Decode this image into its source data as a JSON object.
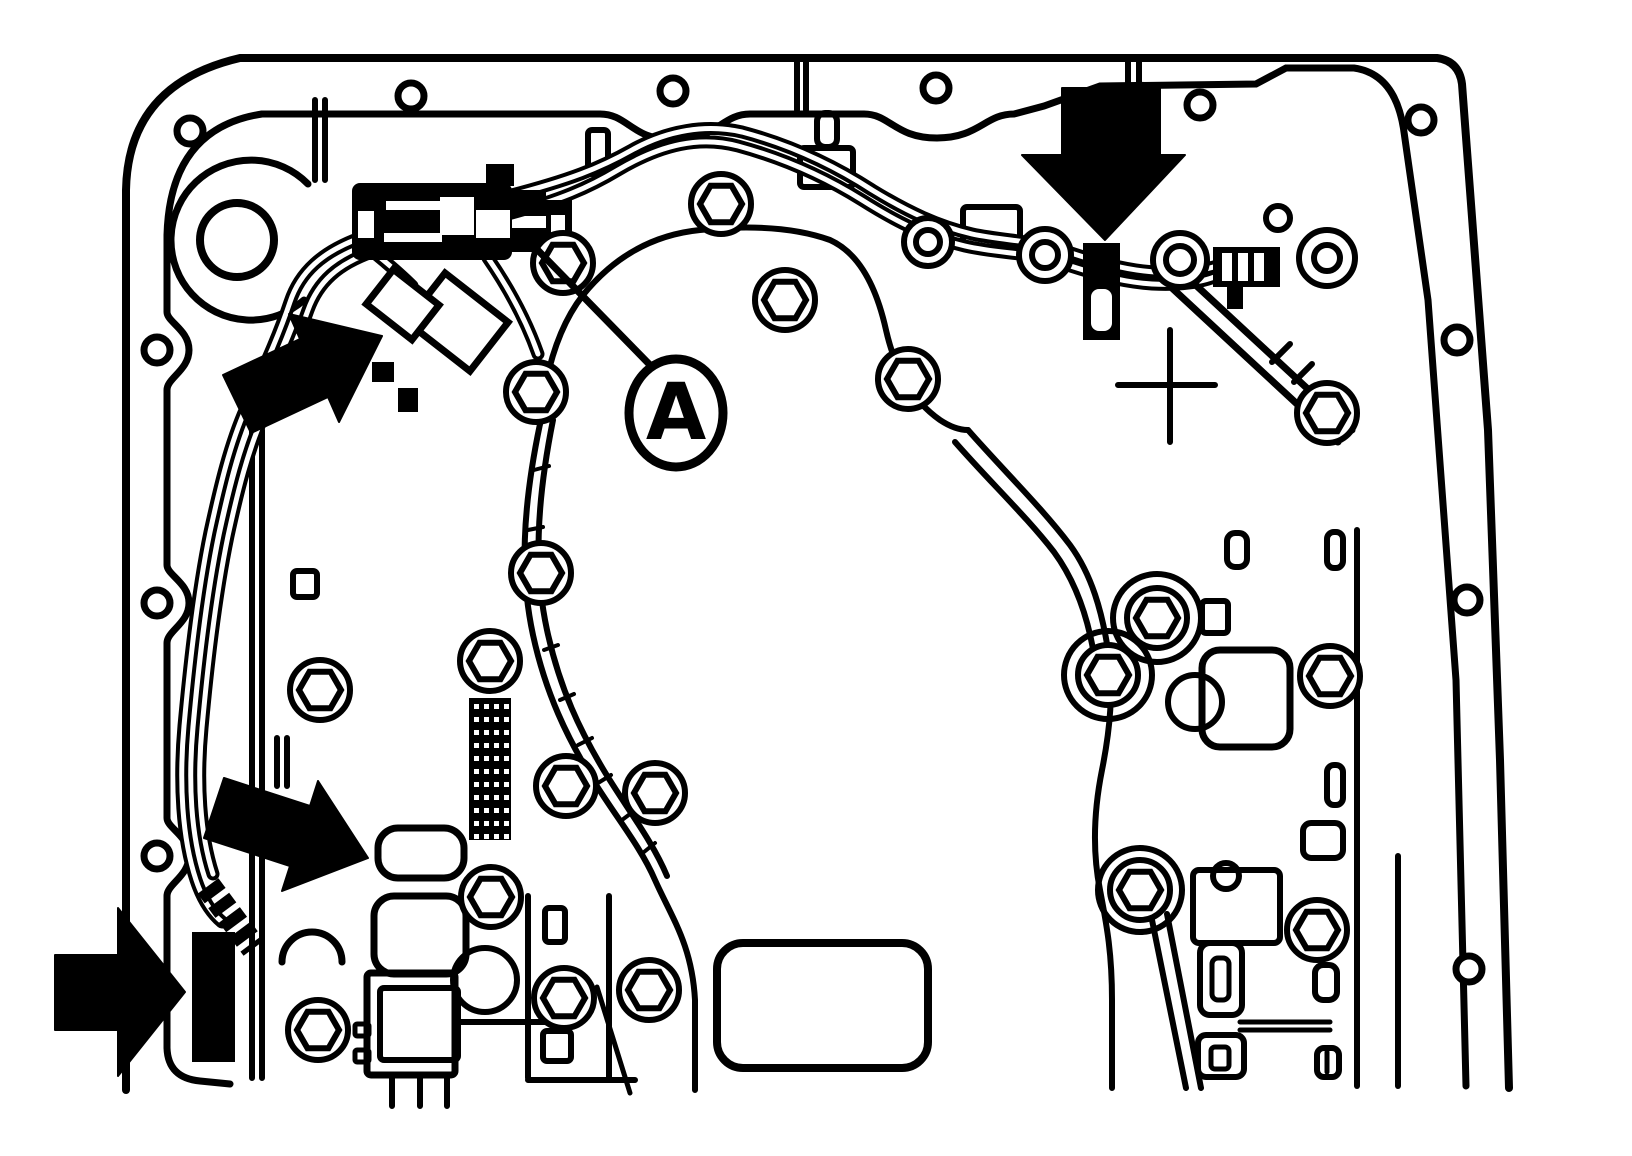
{
  "figure": {
    "kind": "technical-line-drawing",
    "subject": "automatic-transmission-valve-body-with-wiring-harness",
    "background_color": "#ffffff",
    "line_color": "#000000",
    "width": 1632,
    "height": 1156
  },
  "callouts": {
    "a": {
      "text": "A",
      "cx": 676,
      "cy": 413,
      "rx": 47,
      "ry": 54,
      "font_size": 78,
      "leader": "M 651 366 L 522 234"
    }
  },
  "arrows": [
    {
      "name": "arrow-top-right-connector",
      "points": "1062,88 1160,88 1160,155 1185,155 1105,240 1022,155 1062,155",
      "direction": "down"
    },
    {
      "name": "arrow-left-harness-plug",
      "points": "382,336 339,422 328,397 251,433 223,375 300,339 289,314",
      "direction": "up-right"
    },
    {
      "name": "arrow-mid-solenoid",
      "points": "368,858 282,891 290,866 204,838 224,778 310,806 318,781",
      "direction": "down-right"
    },
    {
      "name": "arrow-far-left-solenoid",
      "points": "55,955 118,955 118,908 185,992 118,1076 118,1030 55,1030",
      "direction": "right"
    }
  ],
  "diagram": {
    "case_paths": [
      {
        "d": "M 126 1090 L 126 190 Q 128 84 240 58 L 1437 58 Q 1459 61 1462 84 L 1488 430 L 1500 760 L 1509 1088",
        "w": 8
      },
      {
        "d": "M 262 114 L 600 114 C 628 114 632 140 674 140 C 716 140 722 114 750 114 L 864 114 C 890 114 895 138 937 138 C 979 138 985 114 1014 114 L 1044 106 L 1100 86 L 1256 84 L 1286 68 L 1354 68 Q 1396 74 1404 132 L 1428 300 L 1456 680 L 1466 1086",
        "w": 7
      },
      {
        "d": "M 262 114 Q 170 128 167 235 L 167 312 C 167 322 189 330 189 350 C 189 370 167 378 167 390 L 167 565 C 167 575 189 583 189 603 C 189 623 167 631 167 643 L 167 818 C 167 828 189 836 189 856 C 189 876 167 884 167 896 L 167 1048 Q 168 1078 200 1081 L 230 1084",
        "w": 7
      },
      {
        "d": "M 1357 530 L 1357 1086",
        "w": 6
      },
      {
        "d": "M 1398 856 L 1398 1086",
        "w": 6
      },
      {
        "d": "M 308 184 A 80 80 0 1 0 304 300",
        "w": 7
      },
      {
        "d": "M 540 424 Q 548 340 583 295 Q 630 237 700 230 Q 780 222 830 240 Q 870 258 886 330 Q 900 392 940 420 Q 955 430 968 430",
        "w": 6
      },
      {
        "d": "M 540 424 C 522 510 520 575 533 635 C 546 695 568 738 590 775 C 612 812 640 845 655 880 C 672 918 692 945 695 1000 L 695 1090",
        "w": 6
      },
      {
        "d": "M 553 420 C 536 505 534 570 547 630 C 560 690 581 732 603 769 C 625 806 652 840 667 876",
        "w": 6
      },
      {
        "d": "M 968 430 C 1005 472 1042 508 1070 545 C 1092 575 1102 612 1108 650 C 1114 690 1110 730 1102 770 C 1094 810 1092 850 1100 890 C 1106 922 1112 950 1112 1000 L 1112 1088",
        "w": 6
      },
      {
        "d": "M 955 442 C 990 482 1026 516 1054 552 C 1076 582 1088 618 1094 655",
        "w": 6
      },
      {
        "d": "M 1152 920 L 1186 1088",
        "w": 6
      },
      {
        "d": "M 1167 914 L 1201 1088",
        "w": 6
      },
      {
        "d": "M 252 392 L 252 1078 M 262 430 L 262 1078",
        "w": 6
      },
      {
        "d": "M 277 738 L 277 786 M 287 738 L 287 786",
        "w": 6
      },
      {
        "d": "M 315 100 L 315 180 M 325 100 L 325 180",
        "w": 6
      },
      {
        "d": "M 797 60 L 797 110 M 806 60 L 806 110",
        "w": 6
      },
      {
        "d": "M 1128 62 L 1128 112 M 1139 62 L 1139 112",
        "w": 6
      },
      {
        "d": "M 528 896 L 528 1078 M 609 896 L 609 1078 M 528 1080 L 635 1080",
        "w": 6
      },
      {
        "d": "M 458 1022 L 562 1022",
        "w": 6
      },
      {
        "d": "M 392 1075 L 392 1106 M 420 1075 L 420 1106 M 447 1075 L 447 1106",
        "w": 6
      },
      {
        "d": "M 282 962 A 30 30 0 1 1 342 962",
        "w": 7
      },
      {
        "d": "M 597 987 L 630 1093",
        "w": 5
      },
      {
        "d": "M 1118 385 L 1215 385 M 1170 330 L 1170 442",
        "w": 6
      },
      {
        "d": "M 534 470 L 549 466 M 528 530 L 543 527 M 530 590 L 545 588 M 544 650 L 558 645 M 560 700 L 574 694 M 578 745 L 592 738 M 598 783 L 611 775 M 622 820 L 634 811 M 644 852 L 655 843",
        "w": 4
      },
      {
        "d": "M 1240 1022 L 1330 1022 M 1240 1030 L 1330 1030",
        "w": 5
      },
      {
        "d": "M 1327 1052 L 1327 1072",
        "w": 5
      }
    ],
    "kickdown_paths": [
      {
        "d": "M 1172 288 L 1338 442",
        "w": 7
      },
      {
        "d": "M 1186 276 L 1352 430",
        "w": 7
      },
      {
        "d": "M 1272 362 L 1290 344 M 1294 382 L 1312 364",
        "w": 6
      }
    ],
    "stroke_rects": [
      {
        "x": 293,
        "y": 571,
        "w": 24,
        "h": 26,
        "rx": 4,
        "sw": 6
      },
      {
        "x": 545,
        "y": 908,
        "w": 20,
        "h": 34,
        "rx": 4,
        "sw": 6
      },
      {
        "x": 543,
        "y": 1031,
        "w": 28,
        "h": 30,
        "rx": 4,
        "sw": 6
      },
      {
        "x": 1327,
        "y": 532,
        "w": 16,
        "h": 36,
        "rx": 7,
        "sw": 6
      },
      {
        "x": 1227,
        "y": 533,
        "w": 20,
        "h": 34,
        "rx": 8,
        "sw": 6
      },
      {
        "x": 1327,
        "y": 765,
        "w": 16,
        "h": 40,
        "rx": 7,
        "sw": 6
      },
      {
        "x": 1303,
        "y": 823,
        "w": 40,
        "h": 35,
        "rx": 8,
        "sw": 6
      },
      {
        "x": 1200,
        "y": 943,
        "w": 42,
        "h": 72,
        "rx": 10,
        "sw": 6
      },
      {
        "x": 1212,
        "y": 958,
        "w": 17,
        "h": 42,
        "rx": 6,
        "sw": 5
      },
      {
        "x": 1198,
        "y": 1035,
        "w": 46,
        "h": 42,
        "rx": 8,
        "sw": 6
      },
      {
        "x": 1211,
        "y": 1047,
        "w": 18,
        "h": 22,
        "rx": 4,
        "sw": 5
      },
      {
        "x": 1315,
        "y": 965,
        "w": 22,
        "h": 35,
        "rx": 8,
        "sw": 6
      },
      {
        "x": 1317,
        "y": 1048,
        "w": 22,
        "h": 29,
        "rx": 7,
        "sw": 6
      },
      {
        "x": 1202,
        "y": 650,
        "w": 88,
        "h": 97,
        "rx": 18,
        "sw": 7
      },
      {
        "x": 1202,
        "y": 601,
        "w": 26,
        "h": 32,
        "rx": 4,
        "sw": 6
      },
      {
        "x": 1193,
        "y": 870,
        "w": 87,
        "h": 73,
        "rx": 6,
        "sw": 6
      },
      {
        "x": 963,
        "y": 207,
        "w": 57,
        "h": 40,
        "rx": 4,
        "sw": 6
      },
      {
        "x": 800,
        "y": 148,
        "w": 53,
        "h": 39,
        "rx": 4,
        "sw": 6
      },
      {
        "x": 588,
        "y": 130,
        "w": 20,
        "h": 44,
        "rx": 4,
        "sw": 6
      },
      {
        "x": 817,
        "y": 113,
        "w": 20,
        "h": 34,
        "rx": 8,
        "sw": 6
      },
      {
        "x": 717,
        "y": 943,
        "w": 211,
        "h": 125,
        "rx": 26,
        "sw": 8
      },
      {
        "x": 367,
        "y": 973,
        "w": 88,
        "h": 102,
        "rx": 4,
        "sw": 7
      },
      {
        "x": 355,
        "y": 1024,
        "w": 14,
        "h": 12,
        "rx": 2,
        "sw": 5
      },
      {
        "x": 355,
        "y": 1050,
        "w": 14,
        "h": 12,
        "rx": 2,
        "sw": 5
      },
      {
        "x": 378,
        "y": 828,
        "w": 86,
        "h": 50,
        "rx": 20,
        "sw": 7
      },
      {
        "x": 374,
        "y": 896,
        "w": 92,
        "h": 78,
        "rx": 20,
        "sw": 7
      },
      {
        "x": 380,
        "y": 988,
        "w": 78,
        "h": 72,
        "rx": 4,
        "sw": 6
      }
    ],
    "fill_rects": [
      {
        "x": 372,
        "y": 362,
        "w": 22,
        "h": 20
      },
      {
        "x": 398,
        "y": 388,
        "w": 20,
        "h": 24
      },
      {
        "x": 192,
        "y": 932,
        "w": 43,
        "h": 130
      }
    ],
    "bolt_holes": [
      {
        "cx": 190,
        "cy": 131
      },
      {
        "cx": 411,
        "cy": 96
      },
      {
        "cx": 673,
        "cy": 91
      },
      {
        "cx": 936,
        "cy": 88
      },
      {
        "cx": 1200,
        "cy": 105
      },
      {
        "cx": 1421,
        "cy": 120
      },
      {
        "cx": 157,
        "cy": 350
      },
      {
        "cx": 157,
        "cy": 603
      },
      {
        "cx": 157,
        "cy": 856
      },
      {
        "cx": 1457,
        "cy": 340
      },
      {
        "cx": 1467,
        "cy": 600
      },
      {
        "cx": 1469,
        "cy": 969
      }
    ],
    "plain_circles": [
      {
        "cx": 237,
        "cy": 240,
        "r": 37,
        "sw": 8
      },
      {
        "cx": 1157,
        "cy": 618,
        "r": 44,
        "sw": 6
      },
      {
        "cx": 1108,
        "cy": 675,
        "r": 44,
        "sw": 6
      },
      {
        "cx": 1140,
        "cy": 890,
        "r": 42,
        "sw": 6
      },
      {
        "cx": 1195,
        "cy": 702,
        "r": 27,
        "sw": 6
      },
      {
        "cx": 485,
        "cy": 980,
        "r": 32,
        "sw": 6
      },
      {
        "cx": 1226,
        "cy": 876,
        "r": 13,
        "sw": 6
      },
      {
        "cx": 1278,
        "cy": 218,
        "r": 12,
        "sw": 6
      }
    ],
    "round_bolts": [
      {
        "cx": 1045,
        "cy": 255,
        "r1": 26,
        "r2": 13
      },
      {
        "cx": 1180,
        "cy": 260,
        "r1": 27,
        "r2": 14
      },
      {
        "cx": 1327,
        "cy": 258,
        "r1": 28,
        "r2": 13
      },
      {
        "cx": 928,
        "cy": 242,
        "r1": 24,
        "r2": 12
      }
    ],
    "hex_bolts": [
      {
        "cx": 563,
        "cy": 263
      },
      {
        "cx": 536,
        "cy": 392
      },
      {
        "cx": 721,
        "cy": 204
      },
      {
        "cx": 785,
        "cy": 300
      },
      {
        "cx": 908,
        "cy": 379
      },
      {
        "cx": 541,
        "cy": 573
      },
      {
        "cx": 490,
        "cy": 661
      },
      {
        "cx": 566,
        "cy": 786
      },
      {
        "cx": 655,
        "cy": 793
      },
      {
        "cx": 320,
        "cy": 690
      },
      {
        "cx": 564,
        "cy": 998
      },
      {
        "cx": 649,
        "cy": 990
      },
      {
        "cx": 1157,
        "cy": 618
      },
      {
        "cx": 1108,
        "cy": 675
      },
      {
        "cx": 1330,
        "cy": 676
      },
      {
        "cx": 1140,
        "cy": 890
      },
      {
        "cx": 1317,
        "cy": 930
      },
      {
        "cx": 1327,
        "cy": 413
      },
      {
        "cx": 491,
        "cy": 897
      },
      {
        "cx": 318,
        "cy": 1030
      }
    ],
    "hex_style": {
      "circle_r": 30,
      "hex_r": 21,
      "sw": 6
    },
    "harness_paths": [
      "M 508 214 C 560 200 588 188 618 170 C 662 144 700 136 738 146 C 790 160 830 180 862 200 C 900 224 930 238 965 246 C 1000 254 1028 252 1058 262 C 1095 274 1120 282 1152 284 C 1190 286 1218 280 1235 265",
      "M 508 196 C 570 180 600 168 632 150 C 668 130 706 124 742 132 C 795 146 838 168 872 190 C 908 212 938 226 972 234 C 1005 241 1032 240 1062 250 C 1098 262 1124 270 1155 272 C 1192 274 1220 268 1242 256",
      "M 360 238 C 322 252 300 272 290 302 C 278 338 262 372 246 408 C 230 444 220 486 210 532 C 198 590 190 660 184 726 C 179 782 182 838 196 880 C 202 898 210 912 222 922",
      "M 372 252 C 338 264 318 282 308 310 C 296 344 280 378 264 414 C 248 450 238 490 228 536 C 216 594 208 662 202 728 C 197 782 200 834 213 874",
      "M 366 246 C 386 262 400 274 412 286",
      "M 488 258 C 510 290 526 320 538 354"
    ],
    "harness_style": {
      "outer_w": 13,
      "inner_w": 5
    },
    "conduit": {
      "d": "M 208 886 L 254 948",
      "w": 26,
      "dash": "12 6"
    },
    "grid_block": {
      "x": 469,
      "y": 698,
      "w": 42,
      "h": 142,
      "dot": 5,
      "cols": 4,
      "rows": 11,
      "x0": 474,
      "y0": 704,
      "dx": 10,
      "dy": 13
    },
    "main_connector": {
      "body": {
        "x": 352,
        "y": 183,
        "w": 160,
        "h": 77,
        "rx": 8
      },
      "wing": {
        "x": 486,
        "y": 164,
        "w": 28,
        "h": 22
      },
      "white_parts": [
        {
          "x": 386,
          "y": 201,
          "w": 56,
          "h": 9
        },
        {
          "x": 384,
          "y": 233,
          "w": 58,
          "h": 9
        },
        {
          "x": 358,
          "y": 211,
          "w": 16,
          "h": 27
        },
        {
          "x": 440,
          "y": 197,
          "w": 34,
          "h": 38
        },
        {
          "x": 476,
          "y": 210,
          "w": 34,
          "h": 28
        }
      ],
      "tabs": [
        {
          "x": 512,
          "y": 190,
          "w": 34,
          "h": 26
        },
        {
          "x": 512,
          "y": 228,
          "w": 34,
          "h": 24
        },
        {
          "x": 546,
          "y": 200,
          "w": 26,
          "h": 46
        }
      ],
      "tab_slot": {
        "x": 551,
        "y": 215,
        "w": 14,
        "h": 18
      }
    },
    "right_connector": {
      "body": {
        "x": 1083,
        "y": 243,
        "w": 37,
        "h": 97
      },
      "slot": {
        "x": 1091,
        "y": 289,
        "w": 21,
        "h": 42,
        "rx": 8
      }
    },
    "pin_comb": {
      "body": {
        "x": 1213,
        "y": 247,
        "w": 67,
        "h": 40
      },
      "slots": [
        {
          "x": 1222,
          "y": 253,
          "w": 10,
          "h": 28
        },
        {
          "x": 1238,
          "y": 253,
          "w": 10,
          "h": 28
        },
        {
          "x": 1254,
          "y": 253,
          "w": 10,
          "h": 28
        }
      ],
      "stub": {
        "x": 1227,
        "y": 287,
        "w": 16,
        "h": 22
      }
    },
    "diag_plug": {
      "rot": "rotate(38 435 307)",
      "rects": [
        {
          "x": 422,
          "y": 274,
          "w": 80,
          "h": 62,
          "sw": 7
        },
        {
          "x": 379,
          "y": 303,
          "w": 58,
          "h": 44,
          "sw": 7
        }
      ]
    }
  }
}
